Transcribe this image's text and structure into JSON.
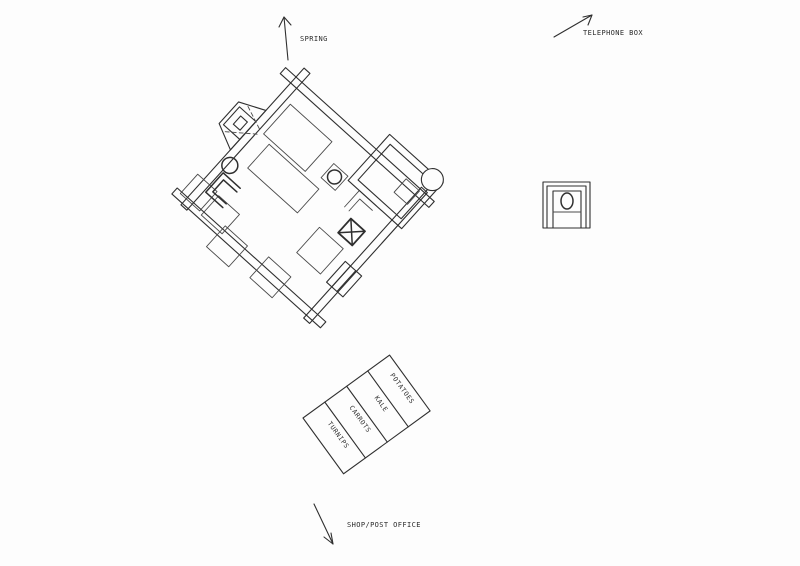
{
  "drawing": {
    "background": "#fdfdfd",
    "ink": "#2f2f2f",
    "labels": {
      "spring": "SPRING",
      "telephone_box": "TELEPHONE BOX",
      "shop_post_office": "SHOP/POST OFFICE"
    },
    "garden": {
      "rows": [
        "TURNIPS",
        "CARROTS",
        "KALE",
        "POTATOES"
      ]
    },
    "arrows": [
      {
        "name": "spring-arrow",
        "direction": "up"
      },
      {
        "name": "telephone-box-arrow",
        "direction": "up-right"
      },
      {
        "name": "shop-post-office-arrow",
        "direction": "down"
      }
    ]
  }
}
